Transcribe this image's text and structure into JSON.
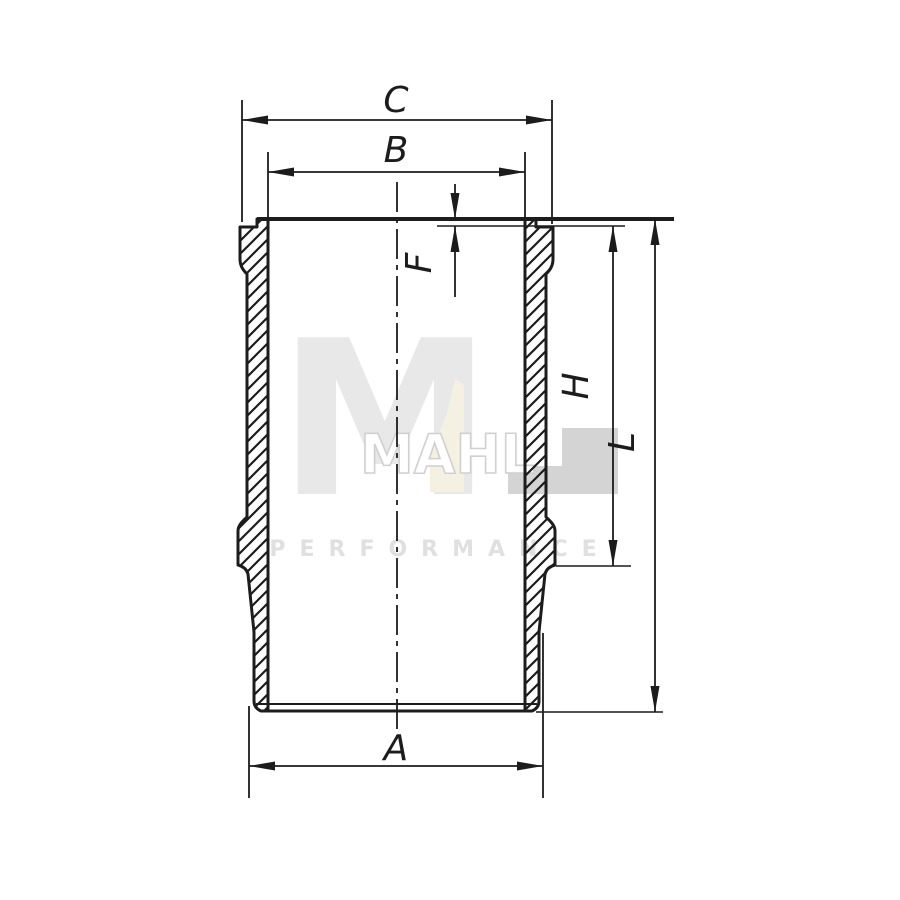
{
  "drawing": {
    "type": "cylinder-liner-cross-section",
    "line_color": "#1c1c1c",
    "background": "#ffffff",
    "dimensions": {
      "c": {
        "label": "C"
      },
      "b": {
        "label": "B"
      },
      "f": {
        "label": "F"
      },
      "h": {
        "label": "H"
      },
      "l": {
        "label": "L"
      },
      "a": {
        "label": "A"
      }
    }
  },
  "watermark": {
    "letter_m": "M",
    "outline_letters": "MAHL",
    "performance_text": "PERFORMANCE",
    "colors": {
      "m_gray": "#e8e8e8",
      "accent_cream": "#f4f1e3",
      "outline_gray": "#d0d0d0",
      "block_gray": "#d4d4d4",
      "performance_gray": "#e0e0e0"
    }
  }
}
